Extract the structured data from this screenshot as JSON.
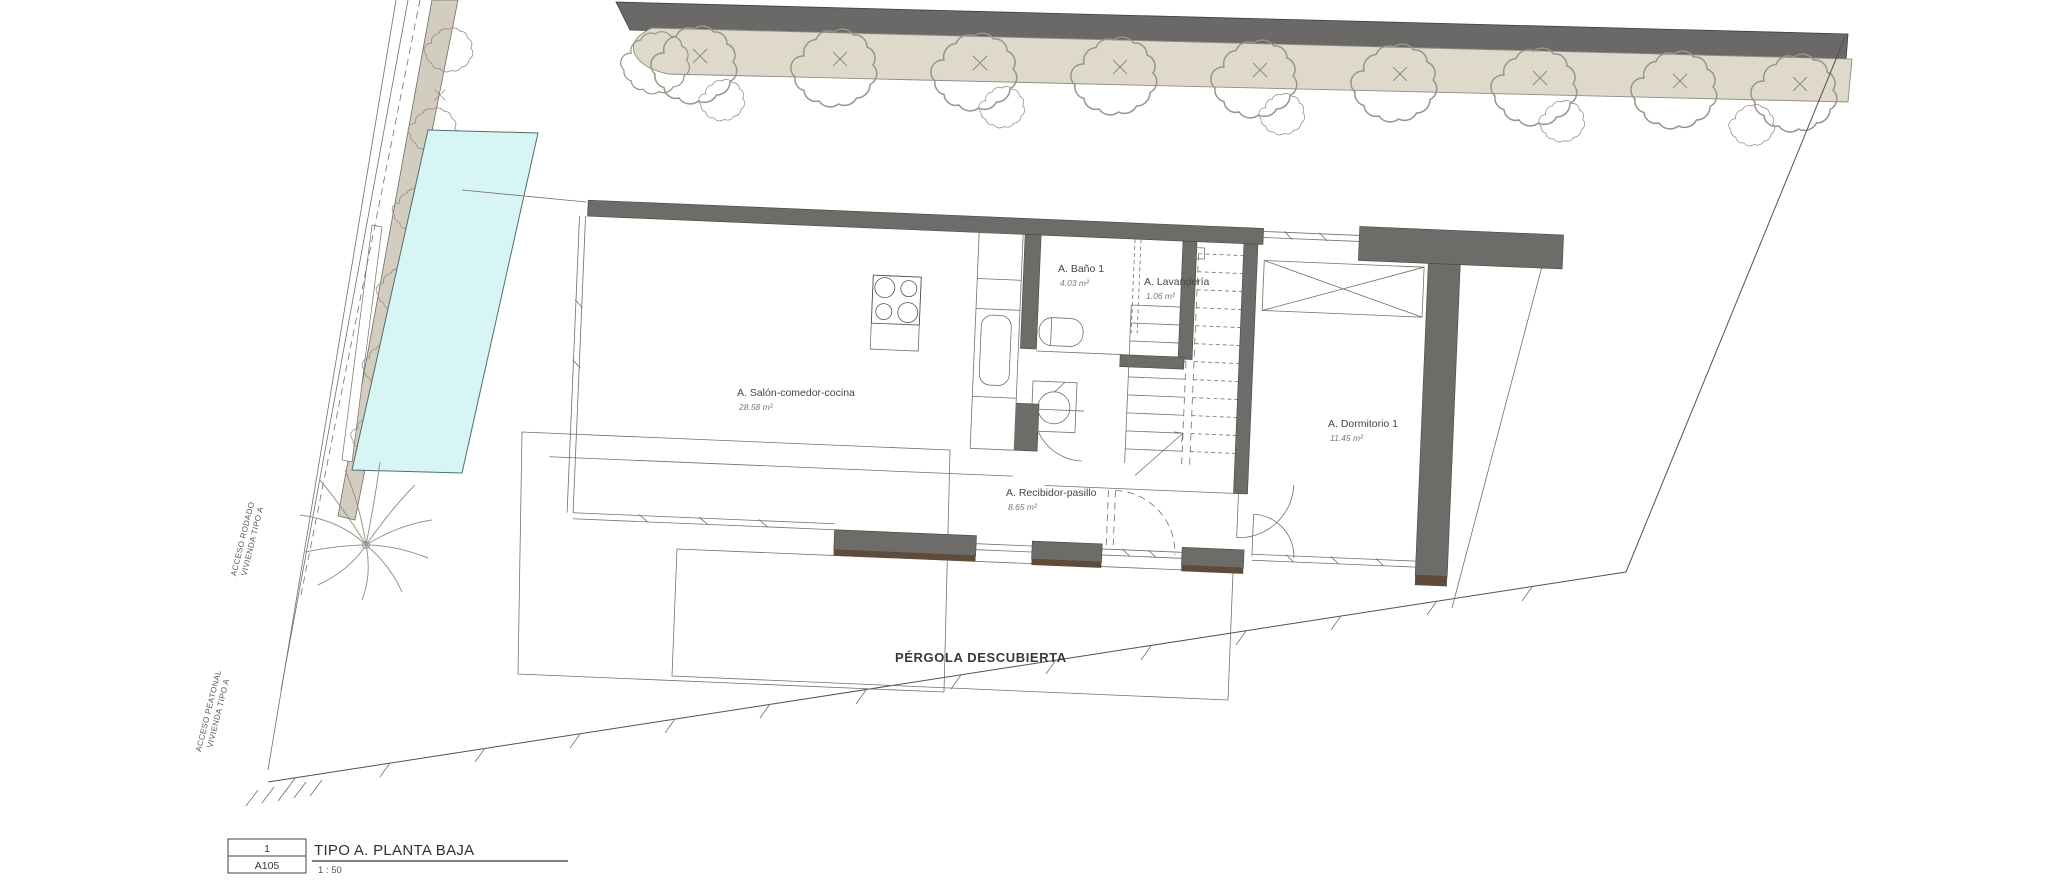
{
  "drawing": {
    "rooms": [
      {
        "name": "A. Salón-comedor-cocina",
        "area": "28.58 m²"
      },
      {
        "name": "A. Baño 1",
        "area": "4.03 m²"
      },
      {
        "name": "A. Lavandería",
        "area": "1.06 m²"
      },
      {
        "name": "A. Dormitorio 1",
        "area": "11.45 m²"
      },
      {
        "name": "A. Recibidor-pasillo",
        "area": "8.65 m²"
      }
    ],
    "site_labels": {
      "pergola": "PÉRGOLA DESCUBIERTA",
      "access_road_line1": "ACCESO RODADO",
      "access_road_line2": "VIVIENDA TIPO A",
      "access_pedestrian_line1": "ACCESO PEATONAL",
      "access_pedestrian_line2": "VIVIENDA TIPO A"
    },
    "title_block": {
      "view_number": "1",
      "sheet_number": "A105",
      "view_title": "TIPO A. PLANTA BAJA",
      "scale": "1 : 50"
    },
    "colors": {
      "wall": "#6e6c69",
      "hedge": "#ded9cb",
      "access_path": "#d2cdbf",
      "pool_water": "#d8f5f6",
      "wood_sill": "#5f4b3a"
    }
  }
}
